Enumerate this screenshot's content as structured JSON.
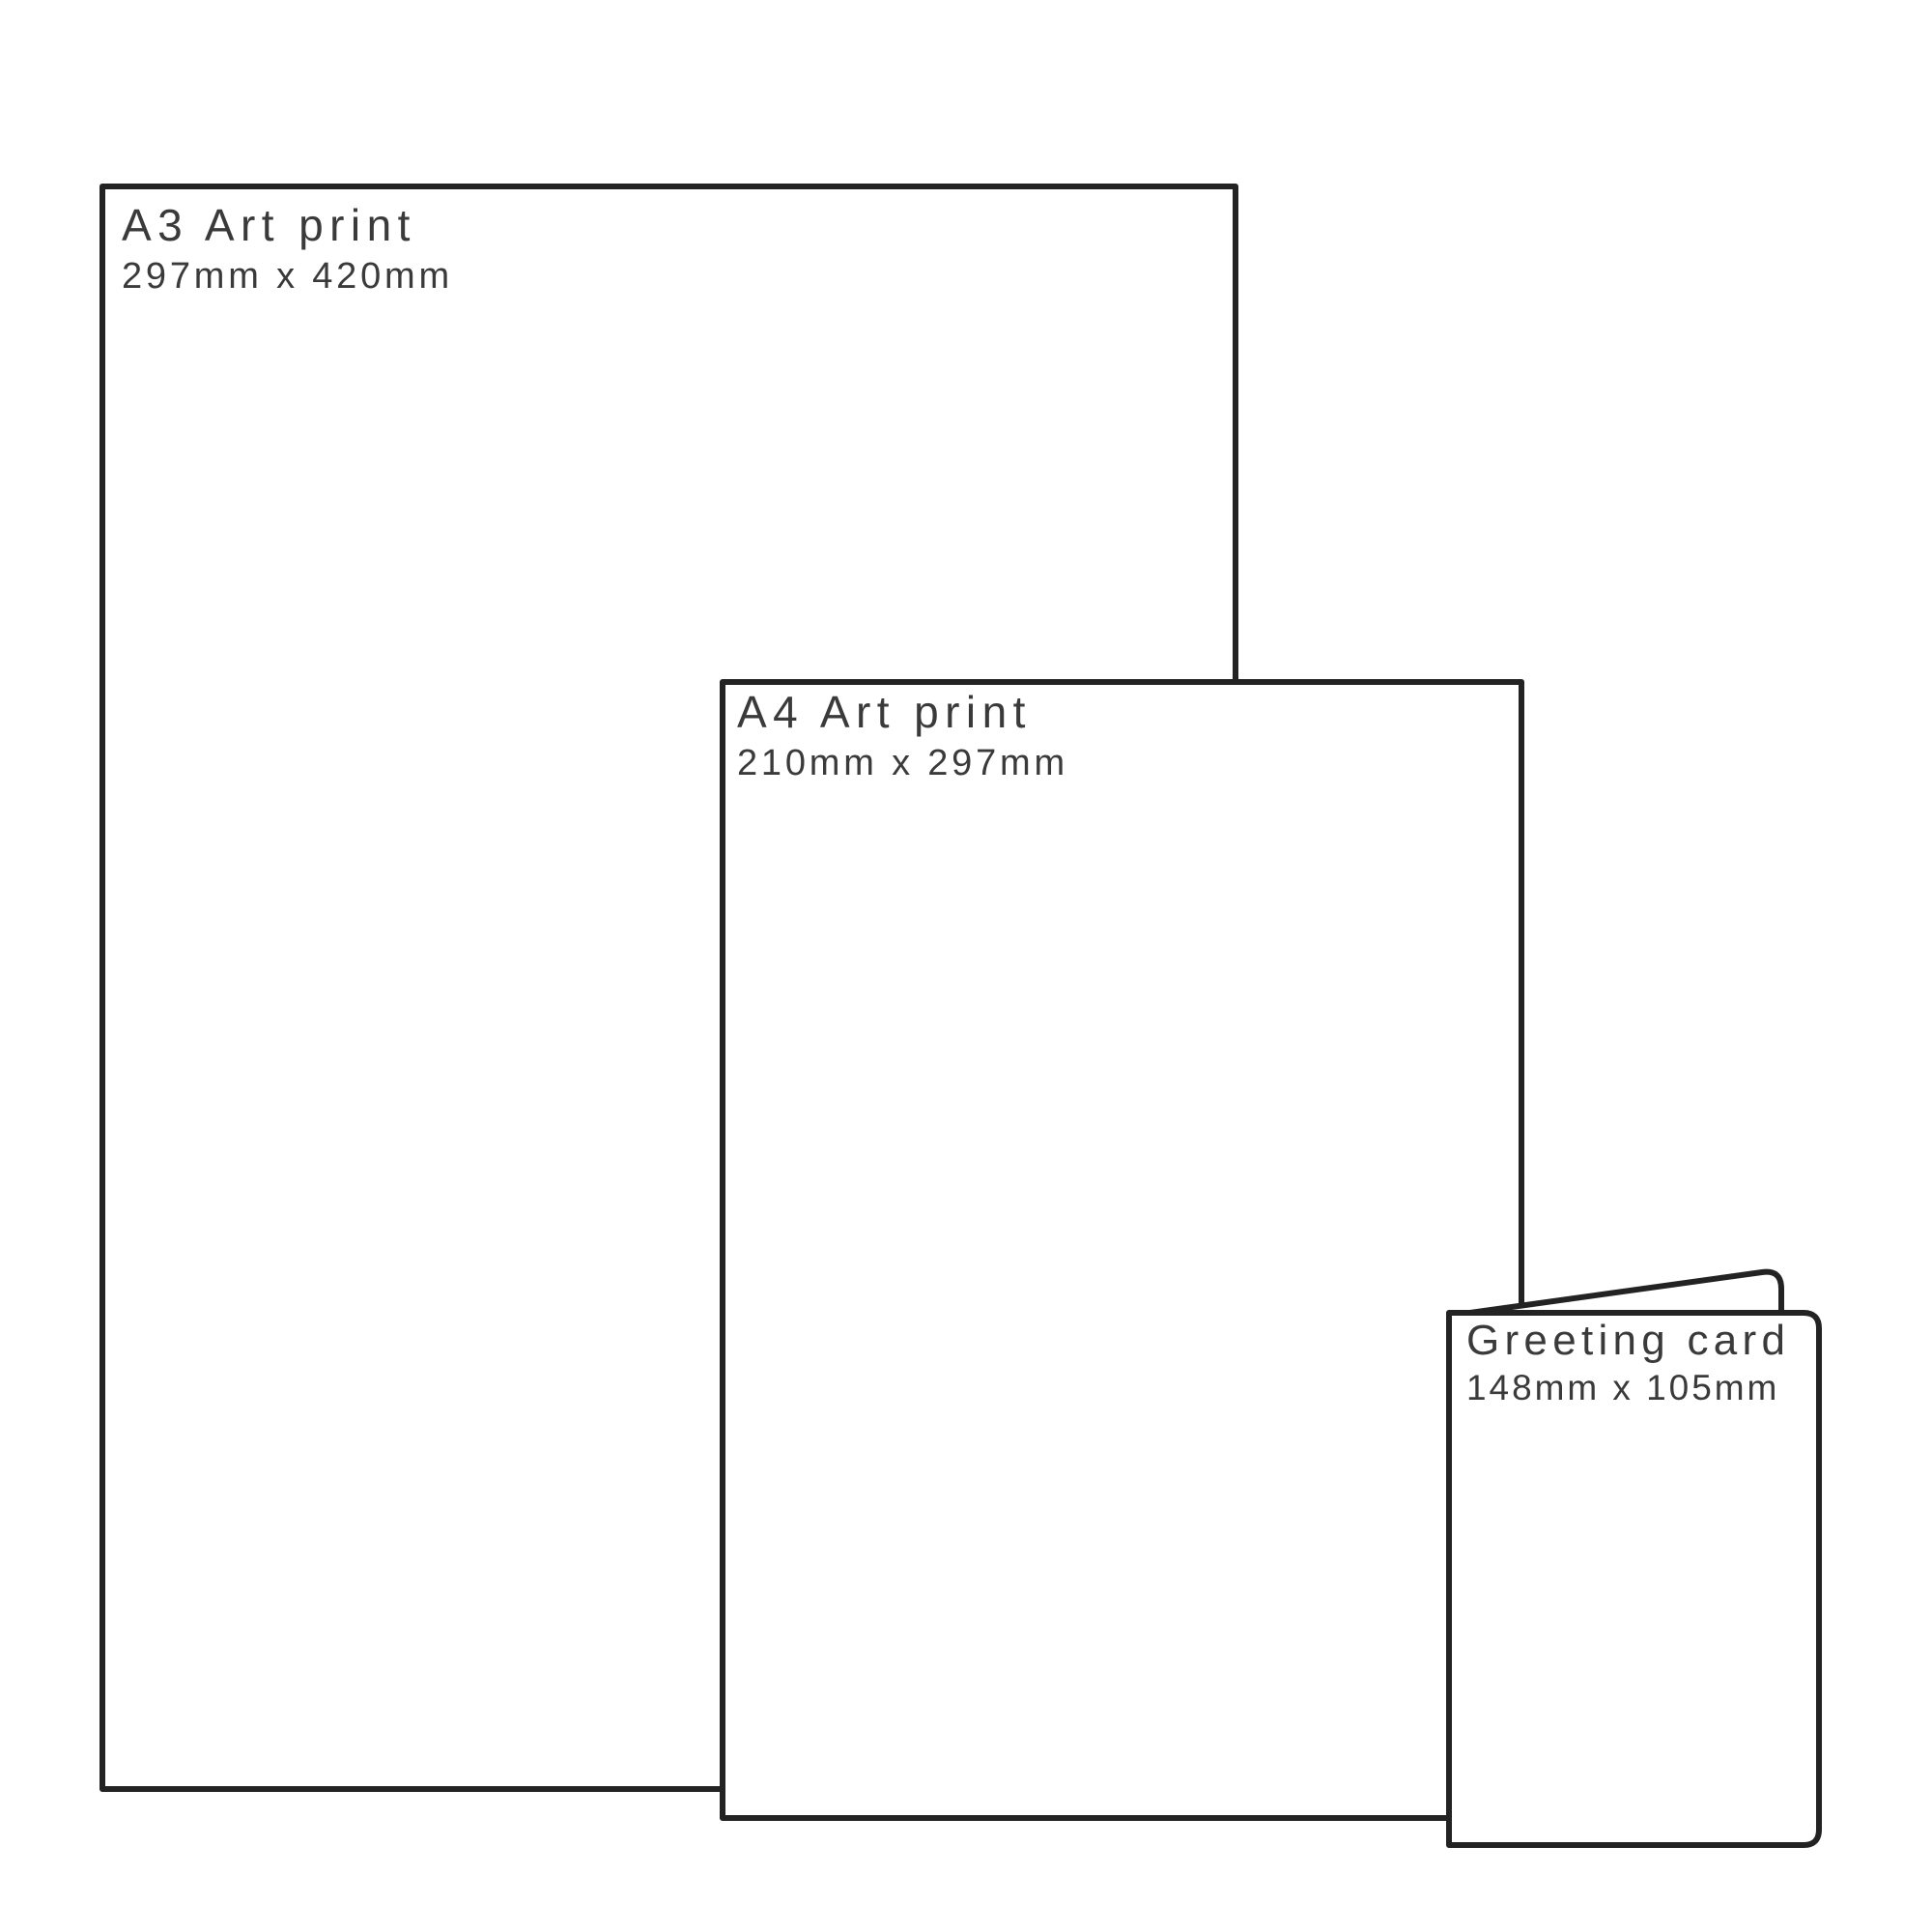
{
  "colors": {
    "background": "#ffffff",
    "outline": "#232323",
    "label_text": "#3a3a3a"
  },
  "prints": [
    {
      "id": "a3-art-print",
      "title": "A3 Art print",
      "dimensions": "297mm x 420mm"
    },
    {
      "id": "a4-art-print",
      "title": "A4 Art print",
      "dimensions": "210mm x 297mm"
    },
    {
      "id": "greeting-card",
      "title": "Greeting card",
      "dimensions": "148mm x 105mm"
    }
  ]
}
